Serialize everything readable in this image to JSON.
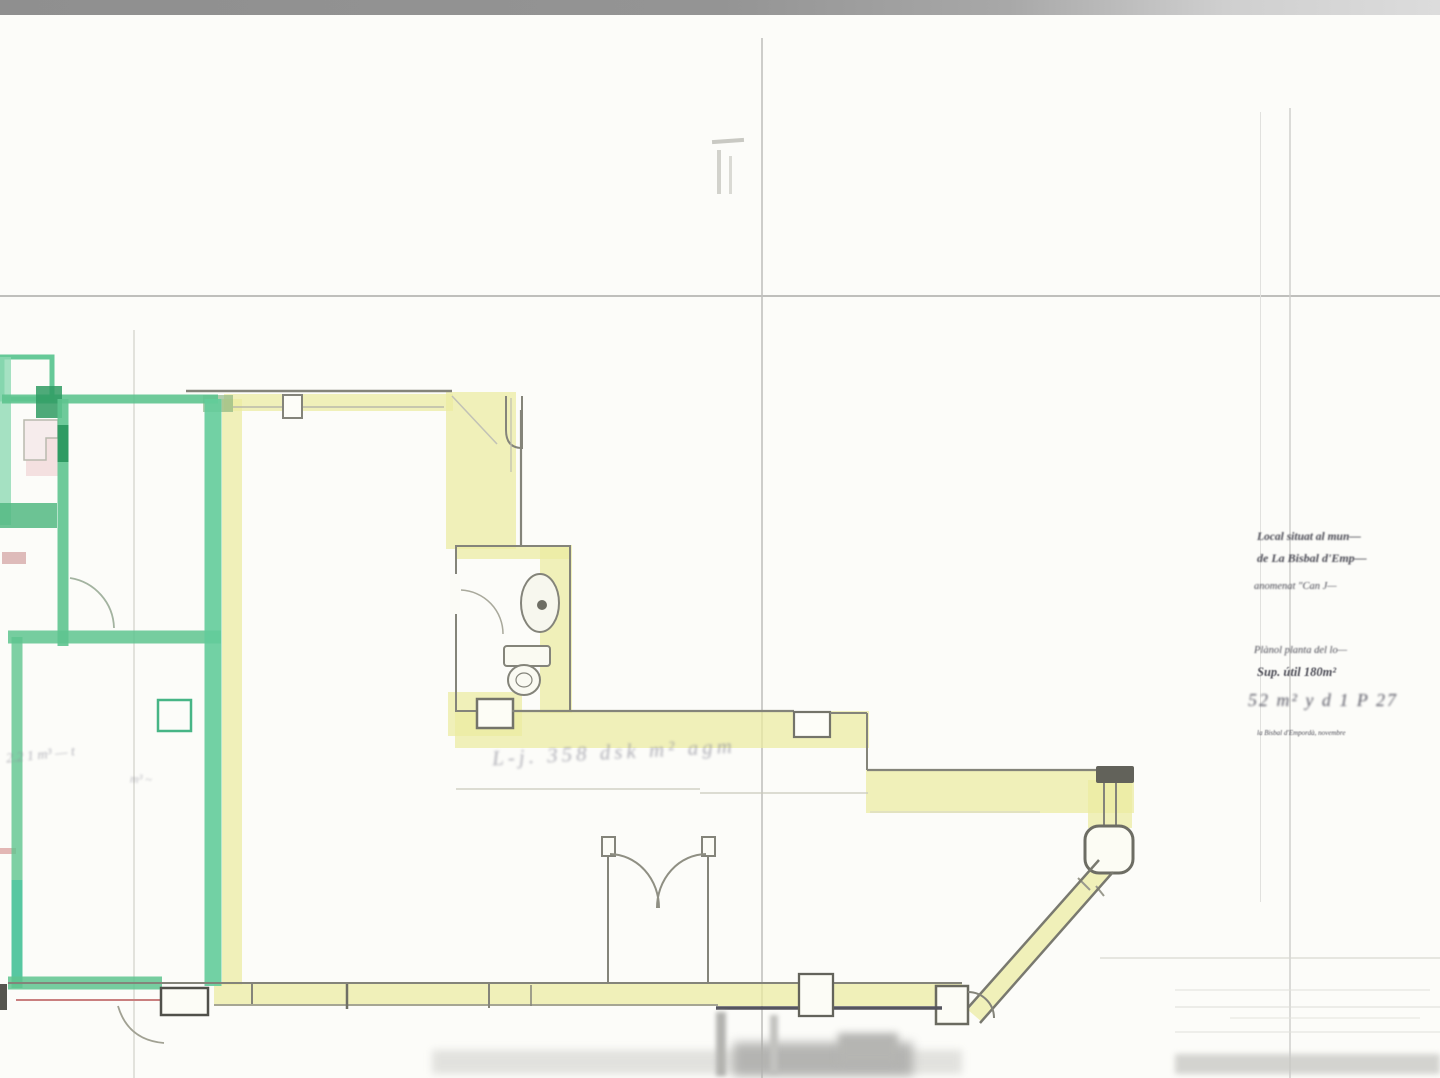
{
  "document": {
    "notes": {
      "line1": "Local situat al mun—",
      "line2": "de La Bisbal d'Emp—",
      "line3": "anomenat \"Can J—",
      "line4": "Plànol planta del lo—",
      "line5": "Sup. útil 180m²",
      "line6": "52 m² y d 1 P 27",
      "line7": "la Bisbal d'Empordà, novembre"
    },
    "annotations": {
      "corridor_scrawl": "L-j. 358 dsk m² agm",
      "green_room_note": "2.2 1 m³ — t",
      "green_room_scrawl": "m³ ~"
    },
    "colors": {
      "highlight_yellow": "#ecec9f",
      "highlight_green": "#5ec48f",
      "highlight_green_dark": "#2f9b63",
      "pencil": "#84847a",
      "fold_line": "#b4b4b1",
      "scan_bar": "#8f8f8f",
      "red_pencil": "#c97f7f"
    }
  }
}
